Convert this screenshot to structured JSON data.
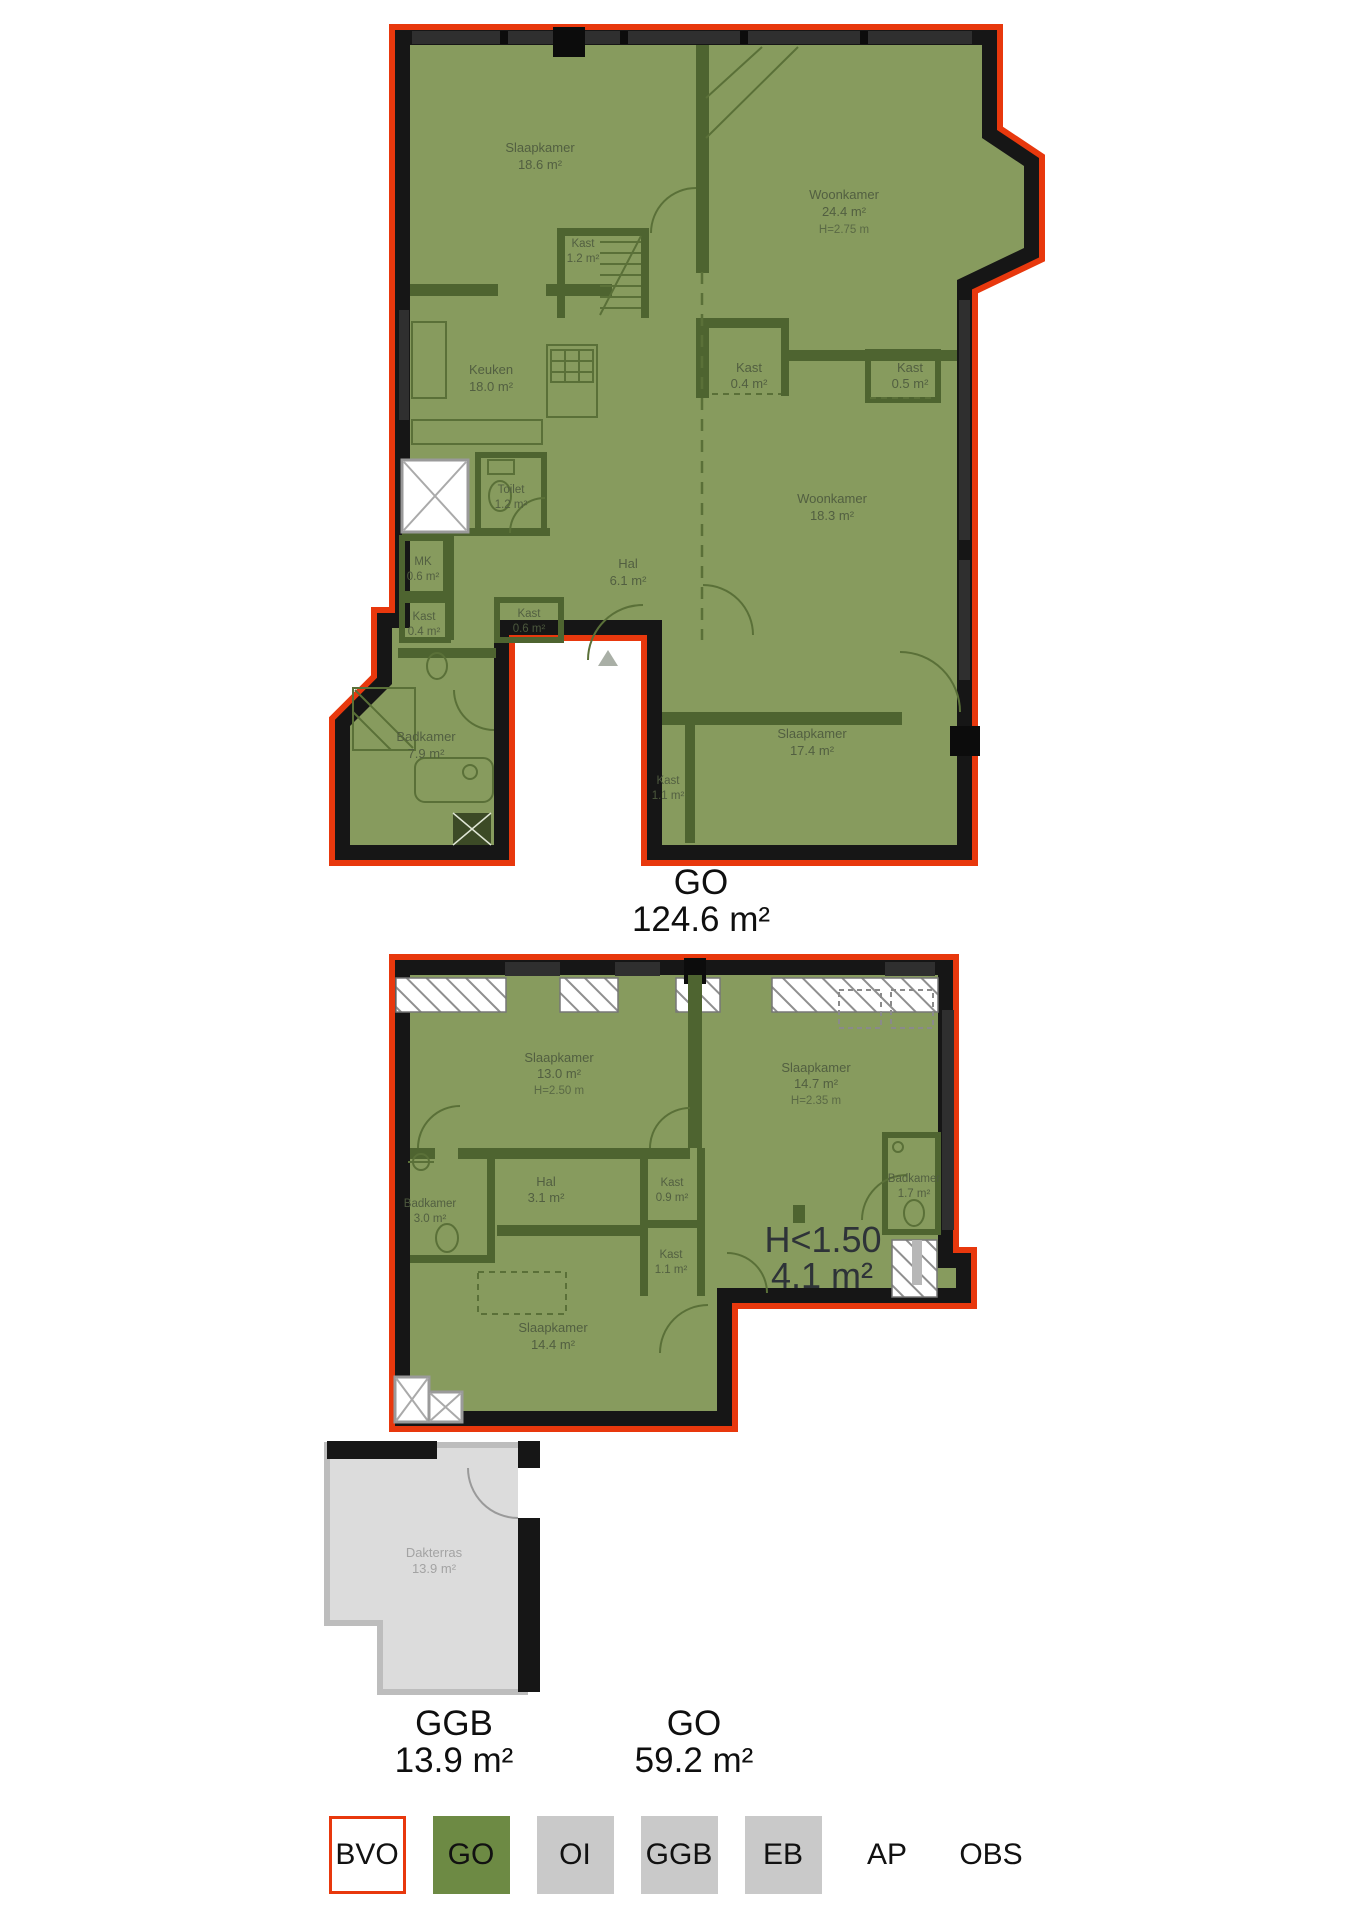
{
  "colors": {
    "bvo_outline": "#e8380d",
    "go_fill": "#879b5e",
    "go_legend": "#6d8a44",
    "wall": "#161616",
    "interior_wall": "#4e6430",
    "ggb_fill": "#dcdcdc",
    "legend_gray": "#c9c9c9"
  },
  "floor1": {
    "rooms": [
      {
        "name": "Slaapkamer",
        "area": "18.6 m²"
      },
      {
        "name": "Woonkamer",
        "area": "24.4 m²",
        "height": "H=2.75 m"
      },
      {
        "name": "Kast",
        "area": "1.2 m²"
      },
      {
        "name": "Keuken",
        "area": "18.0 m²"
      },
      {
        "name": "Kast",
        "area": "0.4 m²"
      },
      {
        "name": "Kast",
        "area": "0.5 m²"
      },
      {
        "name": "Toilet",
        "area": "1.2 m²"
      },
      {
        "name": "Woonkamer",
        "area": "18.3 m²"
      },
      {
        "name": "MK",
        "area": "0.6 m²"
      },
      {
        "name": "Hal",
        "area": "6.1 m²"
      },
      {
        "name": "Kast",
        "area": "0.4 m²"
      },
      {
        "name": "Kast",
        "area": "0.6 m²"
      },
      {
        "name": "Badkamer",
        "area": "7.9 m²"
      },
      {
        "name": "Kast",
        "area": "1.1 m²"
      },
      {
        "name": "Slaapkamer",
        "area": "17.4 m²"
      }
    ],
    "total": {
      "code": "GO",
      "area": "124.6 m²"
    }
  },
  "floor2": {
    "rooms": [
      {
        "name": "Slaapkamer",
        "area": "13.0 m²",
        "height": "H=2.50 m"
      },
      {
        "name": "Slaapkamer",
        "area": "14.7 m²",
        "height": "H=2.35 m"
      },
      {
        "name": "Badkamer",
        "area": "3.0 m²"
      },
      {
        "name": "Hal",
        "area": "3.1 m²"
      },
      {
        "name": "Kast",
        "area": "0.9 m²"
      },
      {
        "name": "Kast",
        "area": "1.1 m²"
      },
      {
        "name": "Badkamer",
        "area": "1.7 m²"
      },
      {
        "name": "Slaapkamer",
        "area": "14.4 m²"
      }
    ],
    "low_height_note": {
      "line1": "H<1.50",
      "line2": "4.1 m²"
    },
    "terrace": {
      "name": "Dakterras",
      "area": "13.9 m²"
    },
    "totals": [
      {
        "code": "GGB",
        "area": "13.9 m²"
      },
      {
        "code": "GO",
        "area": "59.2 m²"
      }
    ]
  },
  "legend": {
    "items": [
      {
        "label": "BVO",
        "style": "bvo"
      },
      {
        "label": "GO",
        "style": "go"
      },
      {
        "label": "OI",
        "style": "gray"
      },
      {
        "label": "GGB",
        "style": "gray"
      },
      {
        "label": "EB",
        "style": "gray"
      },
      {
        "label": "AP",
        "style": "plain"
      },
      {
        "label": "OBS",
        "style": "plain"
      }
    ]
  }
}
